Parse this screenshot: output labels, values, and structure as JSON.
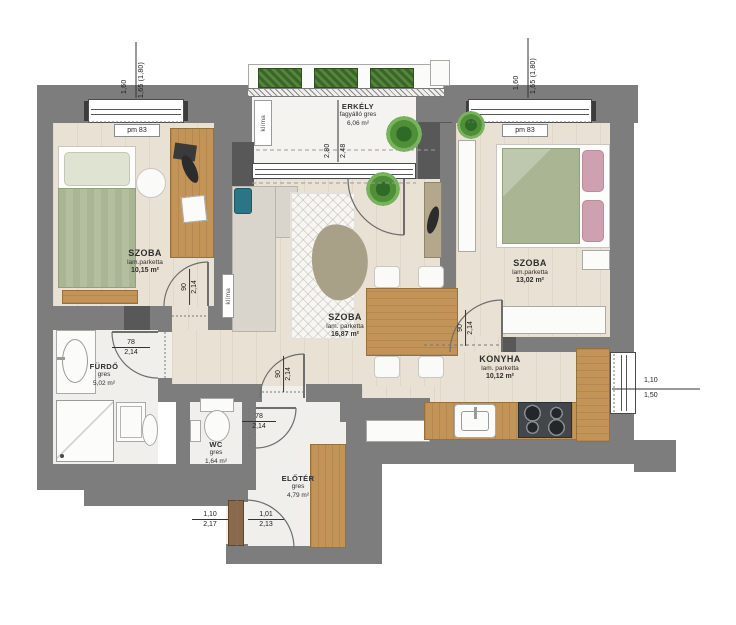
{
  "rooms": {
    "szoba1": {
      "name": "SZOBA",
      "material": "lam.parketta",
      "area": "10,15 m²"
    },
    "erkely": {
      "name": "ERKÉLY",
      "material": "fagyálló gres",
      "area": "6,06 m²"
    },
    "szoba2": {
      "name": "SZOBA",
      "material": "lam.parketta",
      "area": "13,02 m²"
    },
    "nappali": {
      "name": "SZOBA",
      "material": "lam. parketta",
      "area": "16,87 m²"
    },
    "konyha": {
      "name": "KONYHA",
      "material": "lam. parketta",
      "area": "10,12 m²"
    },
    "furdo": {
      "name": "FÜRDŐ",
      "material": "gres",
      "area": "5,02 m²"
    },
    "wc": {
      "name": "WC",
      "material": "gres",
      "area": "1,64 m²"
    },
    "eloter": {
      "name": "ELŐTÉR",
      "material": "gres",
      "area": "4,79 m²"
    }
  },
  "dimensions": {
    "window_left": {
      "top": "1,60",
      "bottom": "1,65 (1,80)"
    },
    "window_right": {
      "top": "1,60",
      "bottom": "1,65 (1,80)"
    },
    "balcony": {
      "outer": "2,80",
      "inner": "2,48"
    },
    "window_kitchen": {
      "top": "1,10",
      "bottom": "1,50"
    },
    "door_bath": {
      "top": "78",
      "bottom": "2,14"
    },
    "door_wc": {
      "top": "78",
      "bottom": "2,14"
    },
    "door_szoba1": {
      "top": "90",
      "bottom": "2,14"
    },
    "door_szoba2": {
      "top": "90",
      "bottom": "2,14"
    },
    "door_eloter": {
      "top": "90",
      "bottom": "2,14"
    },
    "entrance_opening": {
      "top": "1,10",
      "bottom": "2,17"
    },
    "entrance_door": {
      "top": "1,01",
      "bottom": "2,13"
    }
  },
  "labels": {
    "window_type": "pm 83",
    "hvac": "klíma"
  },
  "colors": {
    "wall": "#7d7d7d",
    "wall_dark": "#585858",
    "wood_floor": "#e9e1d4",
    "tile_floor": "#f0efec",
    "bed_green": "#a9b593",
    "pillow_pink": "#cfa0af",
    "accent_teal": "#2b7587",
    "furniture_wood": "#c39457",
    "plant_green": "#4e8f38"
  }
}
